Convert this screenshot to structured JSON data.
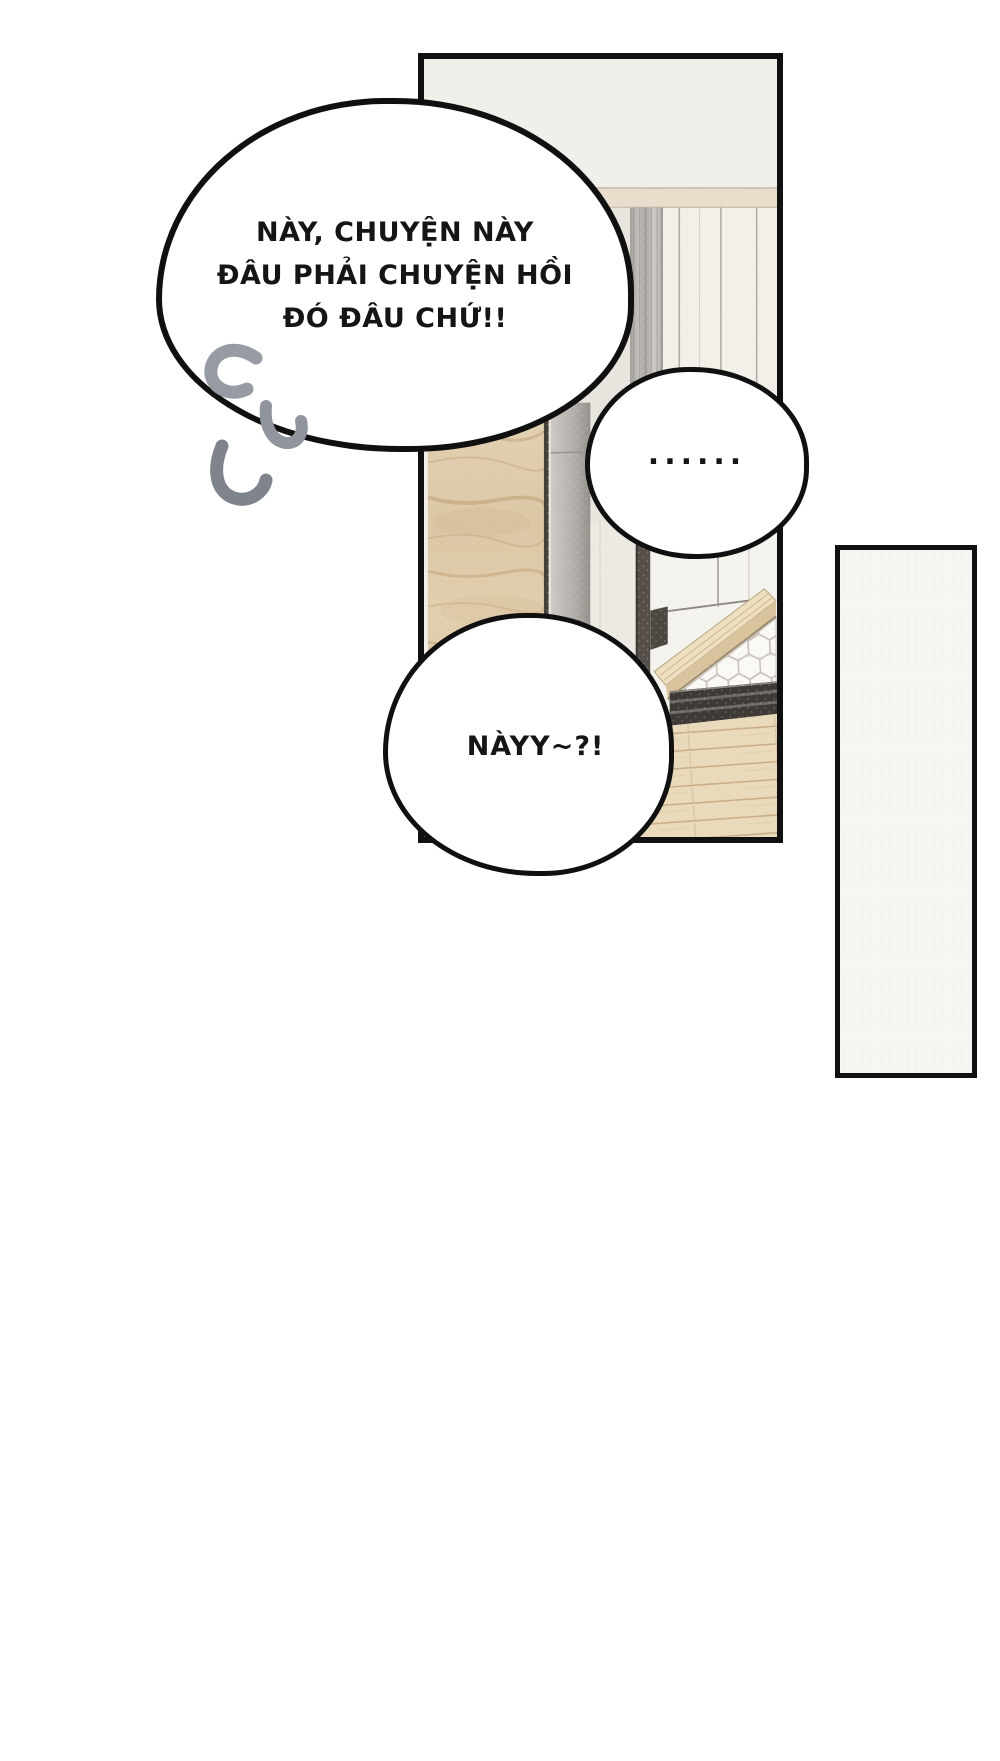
{
  "page": {
    "type": "comic-page",
    "background": "#ffffff"
  },
  "panel": {
    "description": "photo panel: hallway closet with open wood door and entry doorway with hex-tile floor"
  },
  "speech": {
    "bubble_main": {
      "lines": [
        "NÀY, CHUYỆN NÀY",
        "ĐÂU PHẢI CHUYỆN HỒI",
        "ĐÓ ĐÂU CHỨ!!"
      ]
    },
    "bubble_dots": {
      "text": "......"
    },
    "bubble_call": {
      "text": "NÀYY~?!"
    }
  },
  "icons": {
    "tremble_marks": "tremble-marks-icon"
  },
  "colors": {
    "ink": "#101010",
    "paper": "#ffffff",
    "panel-bg": "#f1efe9",
    "rail": "#e8decb",
    "closet": "#f3f0ea",
    "hall": "#e8e5df",
    "wood-edge": "#46403a",
    "frame": "#564f49",
    "step": "#eddfc0",
    "step-front": "#d9c39c",
    "threshold": "#3e3a36",
    "floor": "#e9dabb",
    "hex-bg": "#ebe8e1",
    "hex-tile": "#faf9f6",
    "mark-grey": "#8f949d",
    "side-panel-bg": "#f7f6f3",
    "text": "#151515"
  }
}
